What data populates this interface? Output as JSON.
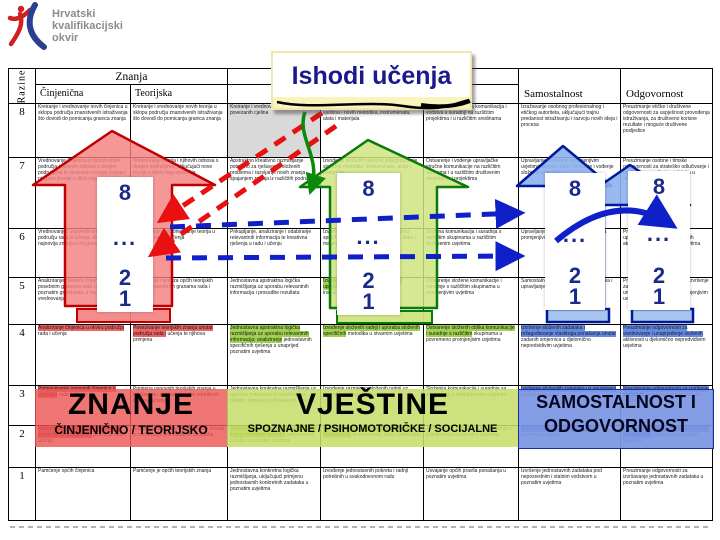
{
  "logo": {
    "line1": "Hrvatski",
    "line2": "kvalifikacijski",
    "line3": "okvir"
  },
  "callout": {
    "title": "Ishodi učenja"
  },
  "arrows": {
    "scale": [
      "8",
      "...",
      "2",
      "1"
    ]
  },
  "footer_labels": {
    "znanje": {
      "title": "ZNANJE",
      "subtitle": "ČINJENIČNO / TEORIJSKO"
    },
    "vjestine": {
      "title": "VJEŠTINE",
      "subtitle": "SPOZNAJNE / PSIHOMOTORIČKE / SOCIJALNE"
    },
    "samostalnost": {
      "title_line1": "SAMOSTALNOST I",
      "title_line2": "ODGOVORNOST"
    }
  },
  "colors": {
    "red_arrow": "#c00000",
    "red_fill": "#f38080",
    "green_arrow": "#0a7a0a",
    "green_fill": "#cfe47e",
    "blue_arrow": "#001a9c",
    "blue_fill": "#8fb0ee",
    "navy_text": "#1a1a8c",
    "gray_cell": "#d9d9d9"
  },
  "table": {
    "razine_label": "Razine",
    "znanja_label": "Znanja",
    "vjestine_label": "Vještine",
    "col_headers": [
      "Činjenična",
      "Teorijska",
      "Spoznajne",
      "Psihomotoričke",
      "Socijalne",
      "Samostalnost",
      "Odgovornost"
    ],
    "rows": [
      {
        "level": "8",
        "cells": [
          {
            "t": "Kreiranje i vrednovanje novih činjenica u sklopu područja znanstvenih istraživanja što dovodi do pomicanja granica znanja"
          },
          {
            "t": "Kreiranje i vrednovanje novih teorija u sklopu područja znanstvenih istraživanja što dovodi do pomicanja granica znanja"
          },
          {
            "t": "Kreiranje i vrednovanje novih i složenih povezanih cjelina",
            "bg": "#d9d9d9"
          },
          {
            "t": "Kreiranje novih istraživačkih i primijenjenih vještina i novih metodika, instrumenata, alata i materijala"
          },
          {
            "t": "Iniciranje novih oblika komunikacija i vodstva u suradnji na različitim projektima i u različitim sredinama"
          },
          {
            "t": "Izražavanje osobnog profesionalnog i etičkog autoriteta, uključujući trajnu predanost istraživanju i razvoju novih ideja i procesa"
          },
          {
            "t": "Preuzimanje etičke i društvene odgovornosti za uspješnost provođenja istraživanja, za društveno korisne rezultate i moguće društvene posljedice"
          }
        ]
      },
      {
        "level": "7",
        "cells": [
          {
            "t": "Vrednovanje činjenica iz raznih novih područja i njihovih odnosa s drugim područjima te stvaranje novoga znanja i njegovo širenje u dijelu toga područja"
          },
          {
            "t": "Vrednovanje teorija i njihovih odnosa s drugim područjima, uključujući nove teorije u dijelu toga područja"
          },
          {
            "t": "Apstraktno kreativno razmišljanje potrebno za rješavanje složenih problema i razvijanje novih znanja spajanjem znanja iz različitih područja"
          },
          {
            "t": "Izvođenje složenih radnji te prilagođavanje složenih metodika, instrumenata, alata i materijala"
          },
          {
            "t": "Ostvarenje i vođenje upravljačke stručne komunikacije na različitim razinama i u različitim društvenim skupinama i projektima"
          },
          {
            "t": "Upravljanje složenim i promjenjivim uvjetima učenja i rada; iniciranje i vođenje složenih projekata"
          },
          {
            "t": "Preuzimanje osobne i timske odgovornosti za strateško odlučivanje i uspješno provođenje zadataka u nepredvidivim uvjetima"
          }
        ]
      },
      {
        "level": "6",
        "cells": [
          {
            "t": "Vrednovanje i uspoređivanje činjenica u području rada ili učenja, dio kojih su najnovija znanja u toj grani"
          },
          {
            "t": "Vrednovanje i uspoređivanje teorija u području rada ili učenja"
          },
          {
            "t": "Prikupljanje, analiziranje i odabiranje relevantnih informacija te kreativna rješenja u radu i učenju"
          },
          {
            "t": "Izvođenje zahtjevnih radnji uz primjenu specifičnih metodika, instrumenata, alata i materijala"
          },
          {
            "t": "Složena komunikacija i suradnja s različitim skupinama u različitim društvenim uvjetima"
          },
          {
            "t": "Upravljanje projektima i aktivnostima u promjenjivim i nepredvidivim uvjetima"
          },
          {
            "t": "Preuzimanje odgovornosti za upravljanje i vrednovanje radnih aktivnosti u nepredvidivim uvjetima"
          }
        ]
      },
      {
        "level": "5",
        "cells": [
          {
            "t": "Analiziranje i sinteza činjenica u posebnim granama rada i učenja, o poznatim granicama, s razumijevanjem vrednovanja"
          },
          {
            "t": "Analiziranje i sinteza općih teorijskih znanja u posebnim granama rada i učenja"
          },
          {
            "t": "Jednostavna apstraktna logička razmišljanja uz uporabu relevantnih informacija i prosudbe rezultata"
          },
          {
            "t": "Izvođenje složenih radnji uz odabir i uporabu odgovarajućih metodika, instrumenata, alata i materijala",
            "hl": "green"
          },
          {
            "t": "Ostvarenje složene komunikacije i suradnje s različitim skupinama u promjenjivim uvjetima"
          },
          {
            "t": "Samostalno izvršenje složenih zadataka i upravljanje u promjenjivim uvjetima"
          },
          {
            "t": "Preuzimanje odgovornosti za izvršenje zadataka te vrednovanje i unaprjeđenje aktivnosti u promjenjivim uvjetima"
          }
        ]
      },
      {
        "level": "4",
        "cells": [
          {
            "t": "Analiziranje činjenica u okviru područja rada i učenja",
            "hl": "red"
          },
          {
            "t": "Povezivanje teorijskih znanja unutar područja rada i učenja te njihova primjena",
            "hl": "red"
          },
          {
            "t": "Jednostavna apstraktna logička razmišljanja uz uporabu relevantnih informacija; analiziranje jednostavnih specifičnih rješenja u unaprijed poznatim uvjetima",
            "hl": "green"
          },
          {
            "t": "Izvođenje složenih radnji i uporaba složenih specifičnih metodika u stvarnim uvjetima",
            "hl": "green"
          },
          {
            "t": "Ostvarenje složenih oblika komunikacije i suradnje s različitim skupinama u povremeno promjenjivim uvjetima",
            "hl": "green"
          },
          {
            "t": "Izvršenje složenih zadataka i prilagođavanje vlastitoga ponašanja unutar zadanih smjernica u djelomično nepredvidivim uvjetima",
            "hl": "blue"
          },
          {
            "t": "Preuzimanje odgovornosti za vrednovanje i unaprjeđenje složenih aktivnosti u djelomično nepredvidivim uvjetima",
            "hl": "blue"
          }
        ]
      },
      {
        "level": "3",
        "cells": [
          {
            "t": "Primjenjivanje osnovnih činjenica u području rada i učenja",
            "hl": "red"
          },
          {
            "t": "Primjena osnovnih teorijskih znanja u izvršavanju zadataka unutar određenih dijelova učenja"
          },
          {
            "t": "Jednostavna konkretna razmišljanja uz uporabu jednostavnih pravila te uz odabir i primjenu jednostavnih metoda"
          },
          {
            "t": "Izvođenje razmjerno složenih radnji uz uporabu odgovarajućih alata"
          },
          {
            "t": "Složenija komunikacija i suradnja sa skupinama u strukturiranim uvjetima"
          },
          {
            "t": "Izvršenje složenijih zadataka uz povremeni nadzor i procjenu",
            "hl": "blue"
          },
          {
            "t": "Preuzimanje odgovornosti za izvršenje složenijih zadataka u strukturiranim uvjetima",
            "hl": "blue"
          }
        ]
      },
      {
        "level": "2",
        "cells": [
          {
            "t": "Razumijevanje činjenica i izvršavanje jednostavnih zadataka u području rada i učenja",
            "hl": "red"
          },
          {
            "t": "Razumijevanje osnovnih teorijskih znanja u izvršavanju jednostavnih zadataka"
          },
          {
            "t": "Jednostavna konkretna razmišljanja za koja je potrebna uporaba jednostavnih pravila u poznatim uvjetima",
            "hl": "green"
          },
          {
            "t": "Izvođenje jednostavnih radnji uz uporabu jednostavnih instrumenata, alata i materijala",
            "hl": "green"
          },
          {
            "t": "Jednostavna komunikacija i suradnja s pojedincima u poznatim uvjetima"
          },
          {
            "t": "Izvršenje jednostavnih zadataka uz povremeni nadzor",
            "hl": "blue"
          },
          {
            "t": "Preuzimanje odgovornosti za izvršenje jednostavnih zadataka u poznatim uvjetima",
            "hl": "blue"
          }
        ]
      },
      {
        "level": "1",
        "cells": [
          {
            "t": "Pamćenje općih činjenica"
          },
          {
            "t": "Pamćenje je općih teorijskih znanja"
          },
          {
            "t": "Jednostavna konkretna logička razmišljanja, uključujući primjenu jednostavnih konkretnih zadataka u poznatim uvjetima"
          },
          {
            "t": "Izvođenje jednostavnih pokreta i radnji potrebnih u svakodnevnom radu"
          },
          {
            "t": "Usvajanje općih pravila ponašanja u poznatim uvjetima"
          },
          {
            "t": "Izvršenje jednostavnih zadataka pod neposrednim i stalnim vodstvom u poznatim uvjetima"
          },
          {
            "t": "Preuzimanje odgovornosti za izvršavanje jednostavnih zadataka u poznatim uvjetima"
          }
        ]
      }
    ]
  }
}
